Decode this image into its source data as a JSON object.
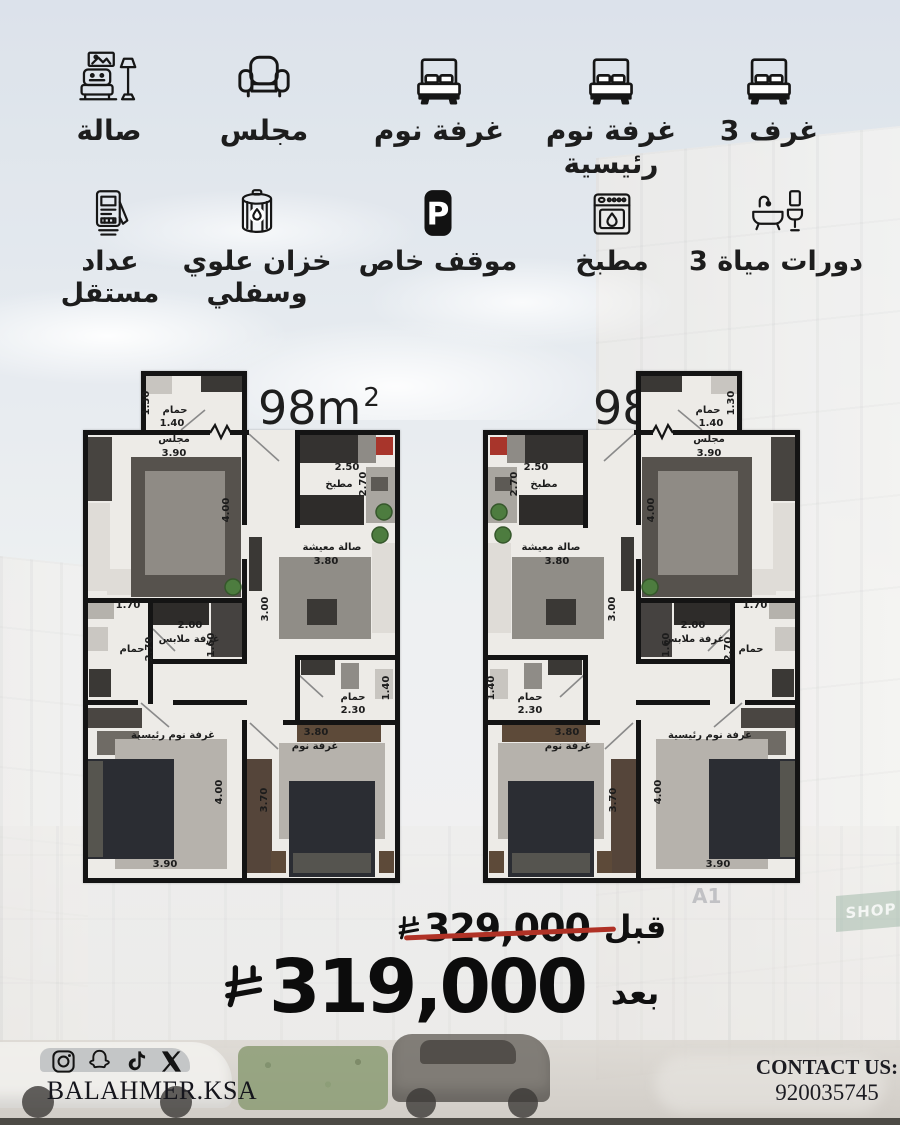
{
  "features": {
    "row1": [
      {
        "id": "living-hall",
        "icon": "sofa-icon",
        "lines": [
          "صالة"
        ]
      },
      {
        "id": "majlis",
        "icon": "armchair-icon",
        "lines": [
          "مجلس"
        ]
      },
      {
        "id": "bedroom",
        "icon": "bed-icon",
        "lines": [
          "غرفة نوم"
        ]
      },
      {
        "id": "master-bedroom",
        "icon": "bed-icon",
        "lines": [
          "غرفة نوم",
          "رئيسية"
        ]
      },
      {
        "id": "three-rooms",
        "icon": "bed-icon",
        "lines": [
          "3 غرف"
        ]
      }
    ],
    "row2": [
      {
        "id": "independent-meter",
        "icon": "meter-icon",
        "lines": [
          "عداد",
          "مستقل"
        ]
      },
      {
        "id": "water-tank",
        "icon": "tank-icon",
        "lines": [
          "خزان علوي",
          "وسفلي"
        ]
      },
      {
        "id": "private-parking",
        "icon": "parking-icon",
        "lines": [
          "موقف خاص"
        ]
      },
      {
        "id": "kitchen",
        "icon": "oven-icon",
        "lines": [
          "مطبخ"
        ]
      },
      {
        "id": "three-bathrooms",
        "icon": "bath-icon",
        "lines": [
          "3 دورات مياة"
        ]
      }
    ]
  },
  "plans": {
    "area_value": "98m",
    "area_exp": "2",
    "rooms": {
      "bath_top": {
        "name": "حمام",
        "w": "1.40",
        "h": "1.30"
      },
      "majlis": {
        "name": "مجلس",
        "w": "3.90",
        "h": "4.00"
      },
      "kitchen": {
        "name": "مطبخ",
        "w": "2.50",
        "h": "2.70"
      },
      "living": {
        "name": "صالة معيشة",
        "w": "3.80",
        "h": "3.00"
      },
      "bath_mid": {
        "name": "حمام",
        "w": "1.70",
        "h": "2.70"
      },
      "dressing": {
        "name": "غرفة ملابس",
        "w": "2.00",
        "h": "1.60"
      },
      "master": {
        "name": "غرفة نوم رئيسية",
        "w": "3.90",
        "h": "4.00"
      },
      "bath_small": {
        "name": "حمام",
        "w": "2.30",
        "h": "1.40"
      },
      "bedroom": {
        "name": "غرفة نوم",
        "w": "3.80",
        "h": "3.70"
      }
    }
  },
  "pricing": {
    "before_label": "قبل",
    "before_value": "329,000",
    "after_label": "بعد",
    "after_value": "319,000",
    "currency_icon": "saudi-riyal-icon",
    "strike_color": "#b03226"
  },
  "footer": {
    "social": [
      "instagram-icon",
      "snapchat-icon",
      "tiktok-icon",
      "x-icon"
    ],
    "handle": "BALAHMER.KSA",
    "contact_label": "CONTACT US:",
    "phone": "920035745"
  },
  "background": {
    "shop_sign": "SHOP",
    "unit_sign": "A1"
  },
  "colors": {
    "wall": "#141414",
    "floor": "#edebe7",
    "accent_red": "#a8352b"
  }
}
